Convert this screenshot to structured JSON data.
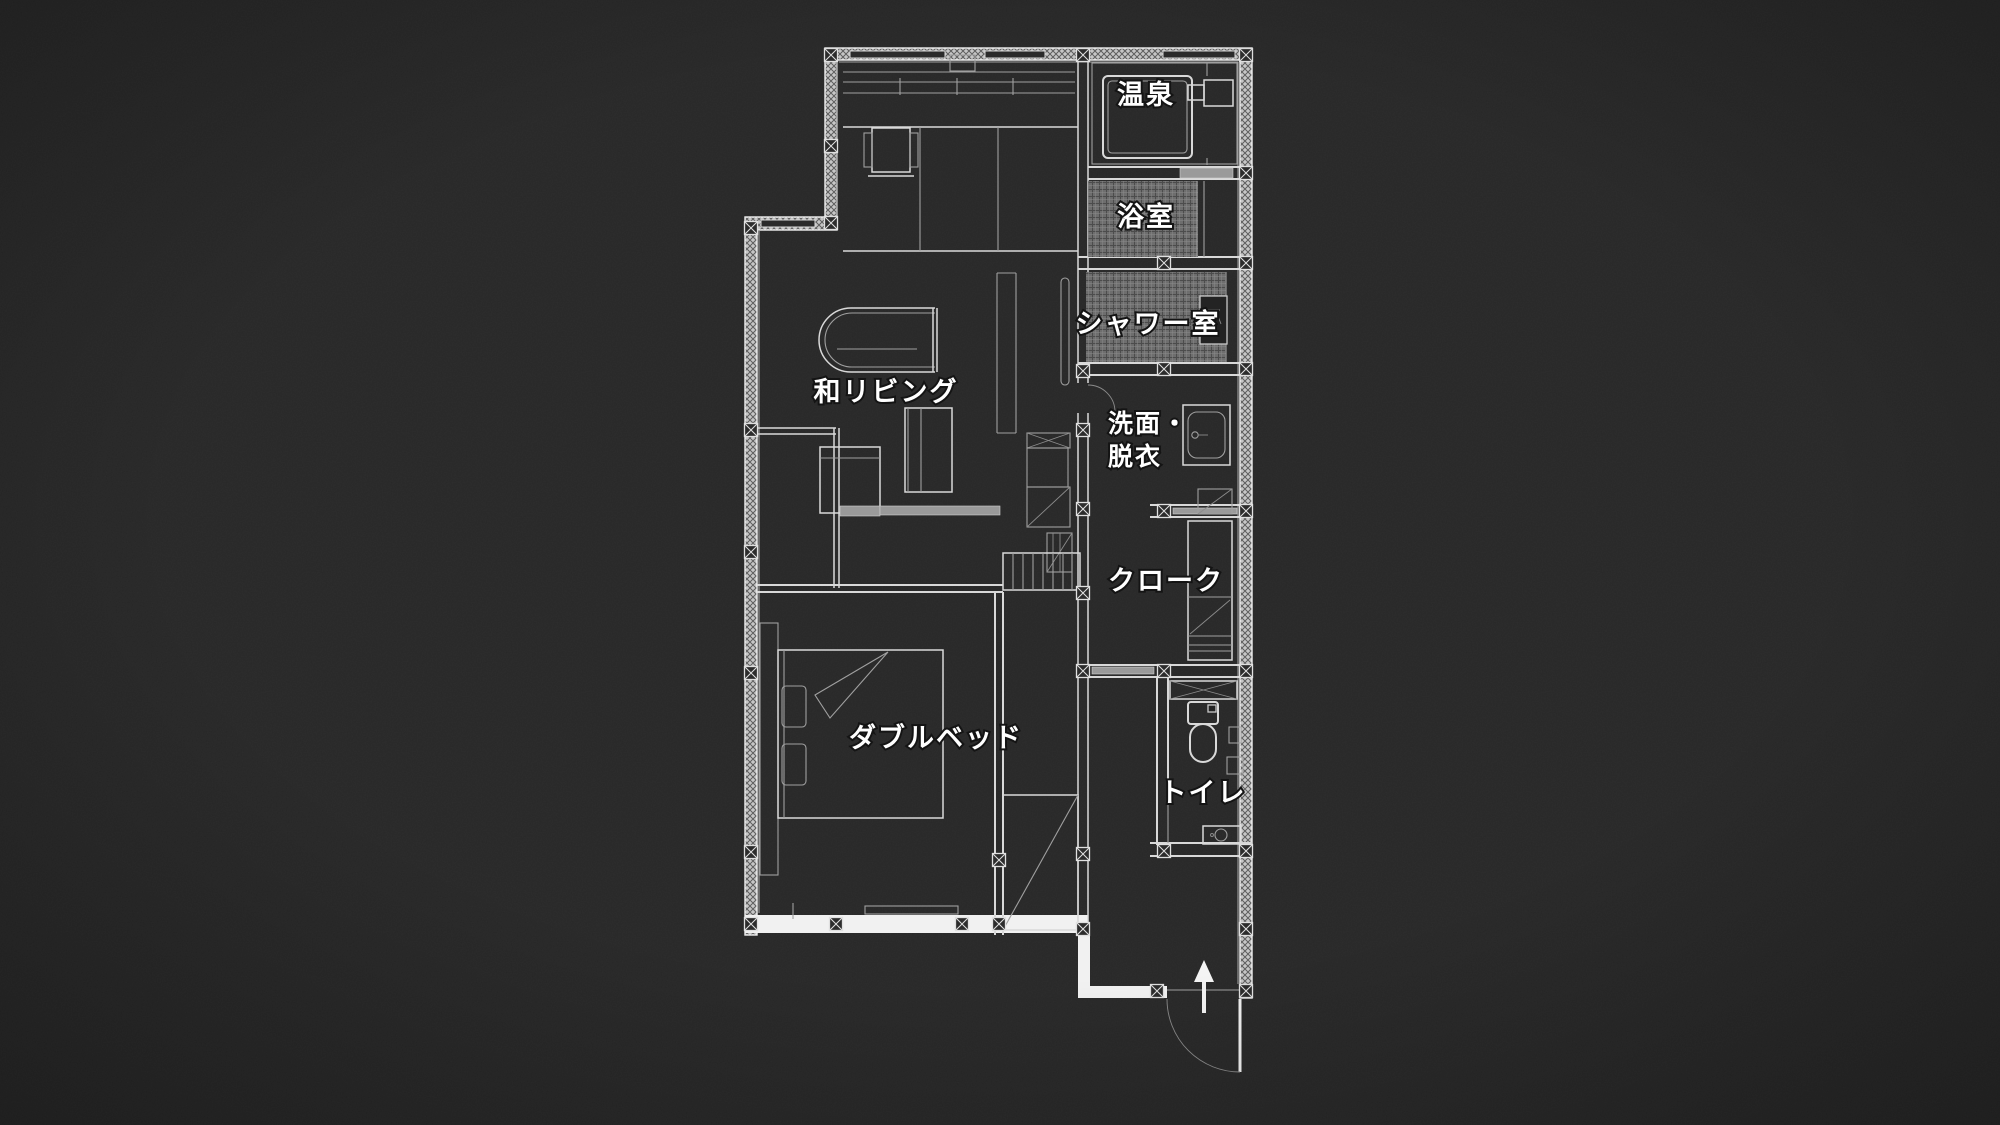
{
  "scene": {
    "description": "Dark architectural floor plan of a Japanese guest suite, white blueprint lines on charcoal background",
    "colors": {
      "bg": "#272727",
      "wall": "#f1f1f1",
      "line": "#d9d9d9",
      "faint": "#a0a0a0",
      "text": "#ffffff",
      "tile": "#6e6e6e",
      "gray": "#9a9a9a"
    }
  },
  "rooms": {
    "onsen": {
      "label": "温泉"
    },
    "bath": {
      "label": "浴室"
    },
    "shower": {
      "label": "シャワー室"
    },
    "washroom": {
      "label_line1": "洗面・",
      "label_line2": "脱衣"
    },
    "cloak": {
      "label": "クローク"
    },
    "toilet": {
      "label": "トイレ"
    },
    "bedroom": {
      "label": "ダブルベッド"
    },
    "living": {
      "label": "和リビング"
    }
  }
}
